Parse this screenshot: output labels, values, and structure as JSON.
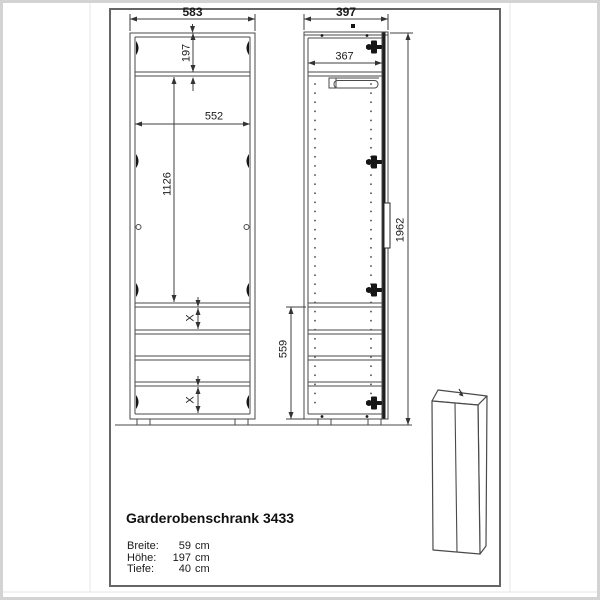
{
  "drawing": {
    "front_view": {
      "overall_width": "583",
      "top_compartment_height": "197",
      "interior_width": "552",
      "middle_compartment_height": "1126",
      "shelf_gap_upper": "X",
      "shelf_gap_lower": "X"
    },
    "side_view": {
      "overall_depth": "397",
      "interior_depth": "367",
      "lower_section_height": "559",
      "overall_height": "1962"
    },
    "title_block": {
      "title": "Garderobenschrank 3433",
      "specs": [
        {
          "label": "Breite:",
          "value": "59",
          "unit": "cm"
        },
        {
          "label": "Höhe:",
          "value": "197",
          "unit": "cm"
        },
        {
          "label": "Tiefe:",
          "value": "40",
          "unit": "cm"
        }
      ]
    }
  }
}
